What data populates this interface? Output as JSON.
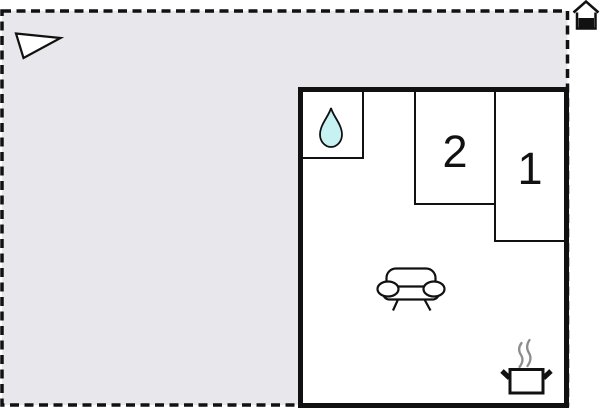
{
  "floor_plan": {
    "room_labels": {
      "bedroom_2": "2",
      "bedroom_1": "1"
    },
    "icons": {
      "outdoor_flag": "pennant-flag-icon",
      "boundary_marker": "house-marker-icon",
      "bathroom": "water-drop-icon",
      "living_room": "sofa-icon",
      "kitchen": "steaming-pot-icon"
    },
    "colors": {
      "background": "#ffffff",
      "outdoor_fill": "#e8e8ec",
      "wall": "#111111",
      "water_drop_fill": "#c6f2f4",
      "steam": "#8d8d8d"
    }
  }
}
